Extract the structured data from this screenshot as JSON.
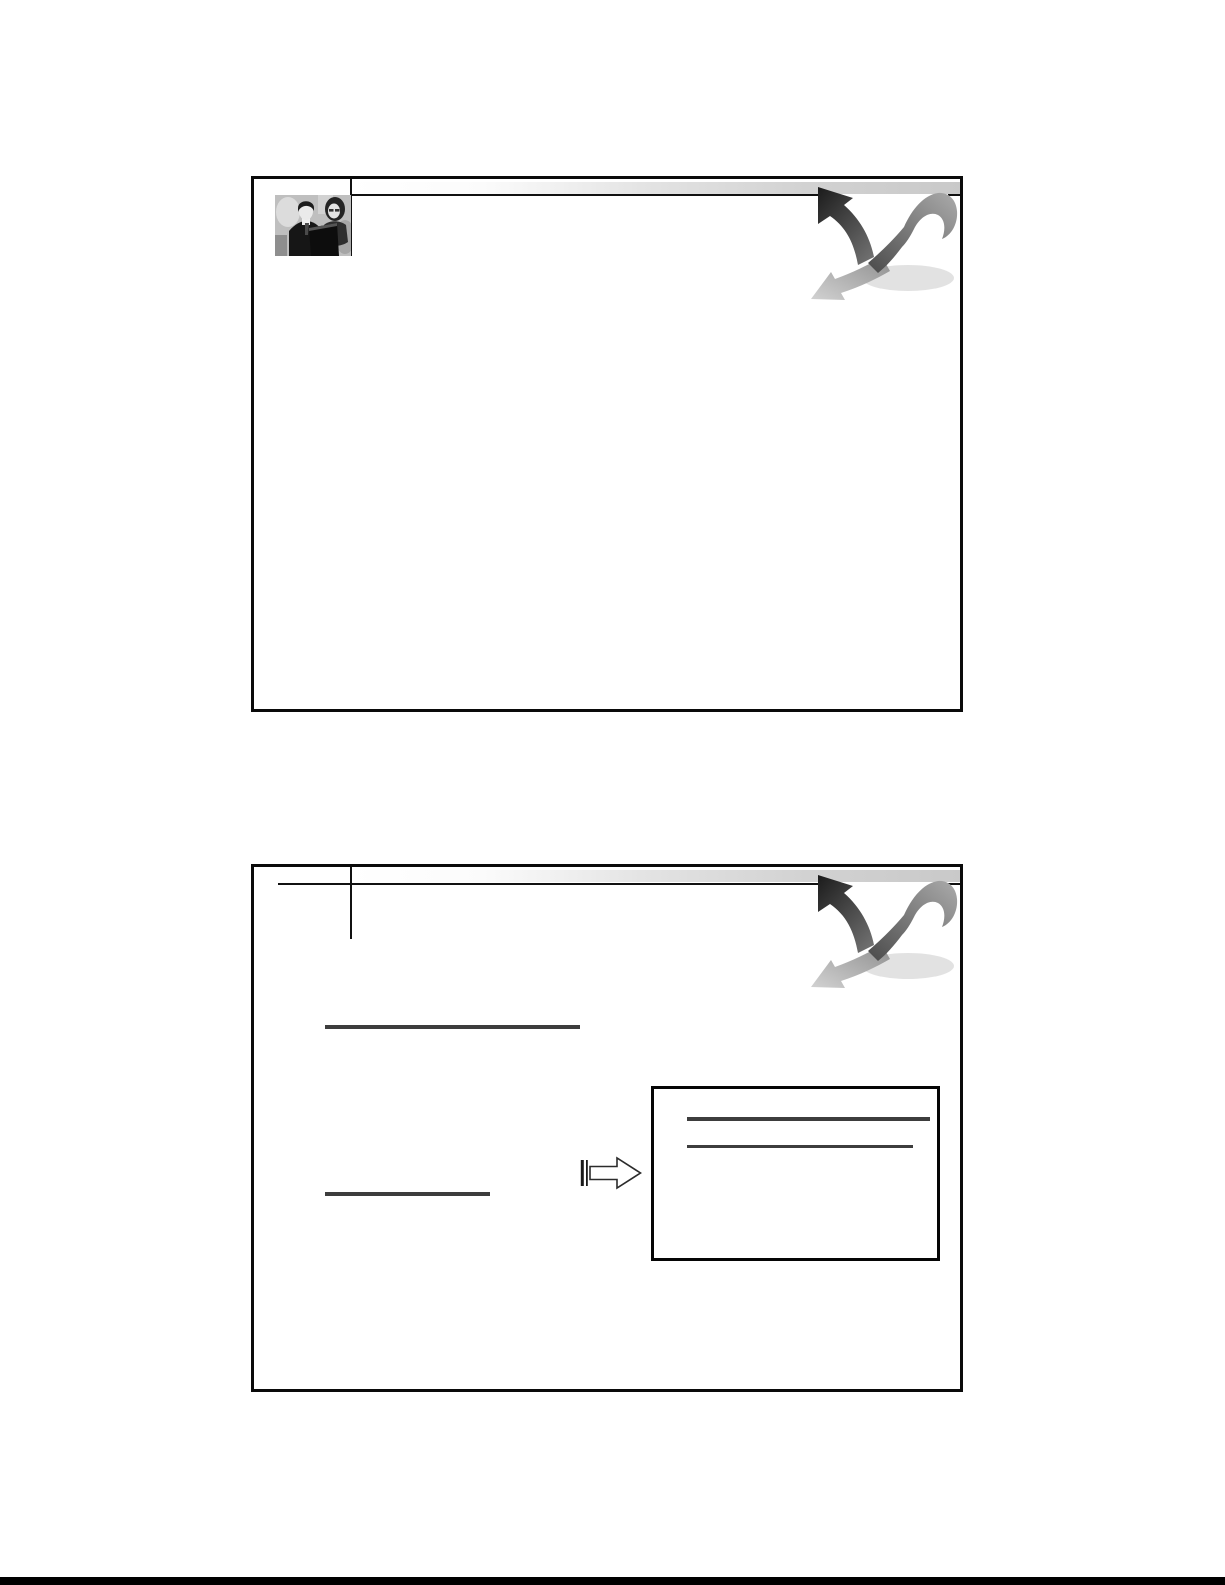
{
  "document": {
    "type": "printed presentation handout, two slide frames, no visible text",
    "slide_count": 2,
    "page_background": "#ffffff",
    "bottom_edge_strip_color": "#000000"
  },
  "colors": {
    "frame_border": "#0a0a0a",
    "header_line": "#111111",
    "band_gradient_start": "#ffffff",
    "band_gradient_end": "#c9c9c9",
    "underline": "#3d3d3d",
    "arrow_dark": "#1f1f1f",
    "arrow_ribbon": "#8a8a8a",
    "arrow_shadow": "#c4c4c4"
  },
  "slide1": {
    "photo_label": "black-and-white photo of two business people",
    "corner_graphic_label": "curved ribbon with up-left dark arrow and down-left gray arrow",
    "body_content": ""
  },
  "slide2": {
    "corner_graphic_label": "curved ribbon with up-left dark arrow and down-left gray arrow",
    "underline_long_label": "long blank underline",
    "underline_short_label": "short blank underline",
    "block_arrow_label": "hollow right-pointing block arrow with striped tail",
    "callout_box_label": "empty box with two ruled lines",
    "body_content": ""
  }
}
